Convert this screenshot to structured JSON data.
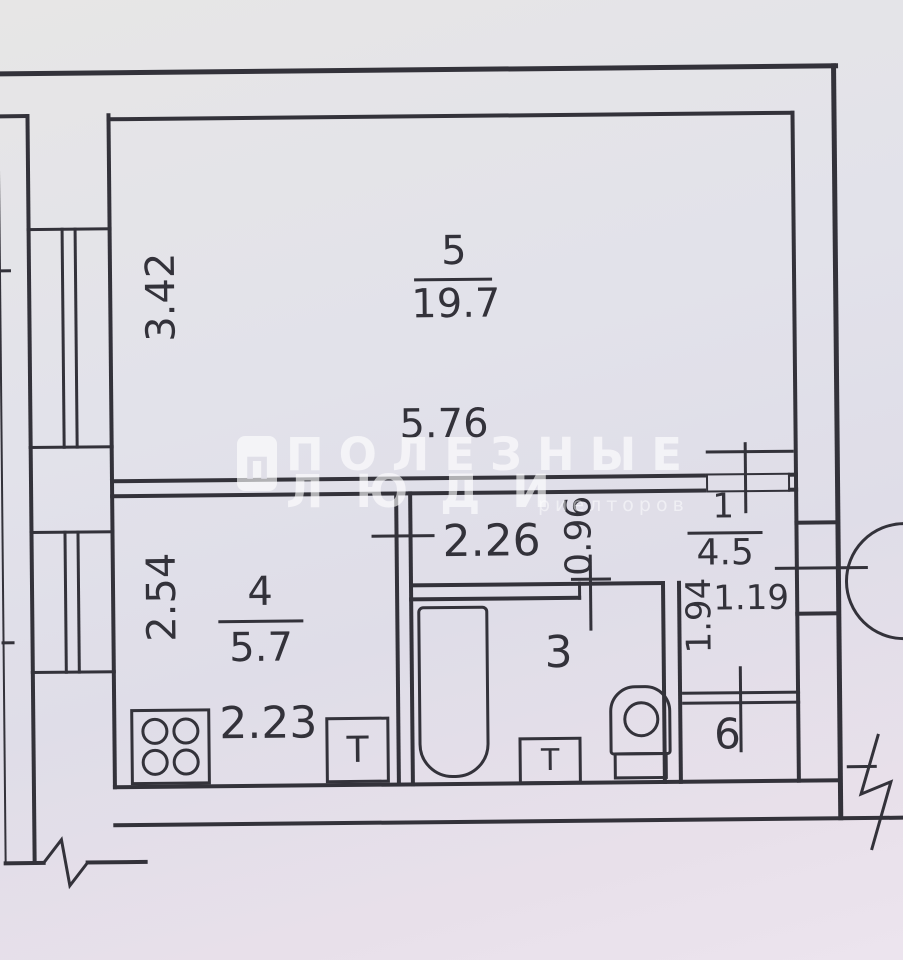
{
  "colors": {
    "ink": "#33323a",
    "paper": "#e2e1e8",
    "watermark": "rgba(255,255,255,0.62)"
  },
  "plan": {
    "type": "apartment-floor-plan",
    "rooms": [
      {
        "number": "5",
        "area": "19.7"
      },
      {
        "number": "4",
        "area": "5.7"
      },
      {
        "number": "1",
        "area": "4.5"
      },
      {
        "number": "3"
      },
      {
        "number": "6"
      }
    ],
    "dimensions": {
      "room5_width": "5.76",
      "room5_height": "3.42",
      "room4_width": "2.23",
      "room4_height": "2.54",
      "bath_width": "2.26",
      "bath_door": "0.96",
      "hall_width": "1.19",
      "hall_height": "1.94"
    }
  },
  "fixtures": {
    "stove_burners": 4,
    "sink_label": "T"
  },
  "watermark": {
    "logo_letter": "П",
    "line1": "ПОЛЕЗНЫЕ",
    "line2": "ЛЮДИ",
    "subtext": "риелторов"
  }
}
